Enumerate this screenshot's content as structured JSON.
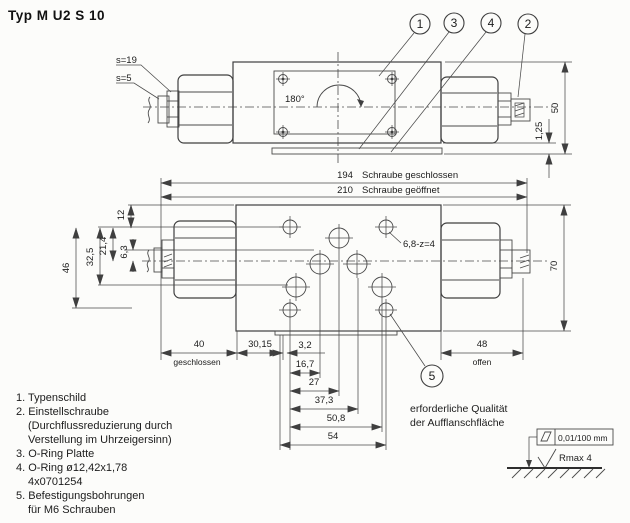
{
  "title": "Typ M U2 S 10",
  "colors": {
    "line": "#3f3f3f",
    "background": "#fcfcfa",
    "text": "#1c1c1c"
  },
  "balloons": {
    "b1": "1",
    "b2": "2",
    "b3": "3",
    "b4": "4",
    "b5": "5"
  },
  "top_view": {
    "s19": "s=19",
    "s5": "s=5",
    "angle": "180°",
    "dim_height": "50",
    "dim_plate": "1,25"
  },
  "bottom_view": {
    "dim_closed_value": "194",
    "dim_closed_label": "Schraube geschlossen",
    "dim_open_value": "210",
    "dim_open_label": "Schraube geöffnet",
    "dim_12": "12",
    "dim_21_4": "21,4",
    "dim_6_3": "6,3",
    "dim_32_5": "32,5",
    "dim_46": "46",
    "dim_70": "70",
    "dim_40": "40",
    "dim_40_label": "geschlossen",
    "dim_30_15": "30,15",
    "dim_3_2": "3,2",
    "dim_16_7": "16,7",
    "dim_27": "27",
    "dim_37_3": "37,3",
    "dim_50_8": "50,8",
    "dim_54": "54",
    "dim_48": "48",
    "dim_48_label": "offen",
    "mounting_hole_label": "6,8-z=4"
  },
  "notes": [
    {
      "text": "1. Typenschild"
    },
    {
      "text": "2. Einstellschraube"
    },
    {
      "text": "(Durchflussreduzierung durch"
    },
    {
      "text": "Verstellung im Uhrzeigersinn)"
    },
    {
      "text": "3. O-Ring Platte"
    },
    {
      "text": "4. O-Ring ø12,42x1,78"
    },
    {
      "text": "4x0701254"
    },
    {
      "text": "5. Befestigungsbohrungen"
    },
    {
      "text": "für M6 Schrauben"
    }
  ],
  "surface_quality": {
    "line1": "erforderliche Qualität",
    "line2": "der Aufflanschfläche",
    "flatness_spec": "0,01/100 mm",
    "roughness_spec": "Rmax 4"
  }
}
